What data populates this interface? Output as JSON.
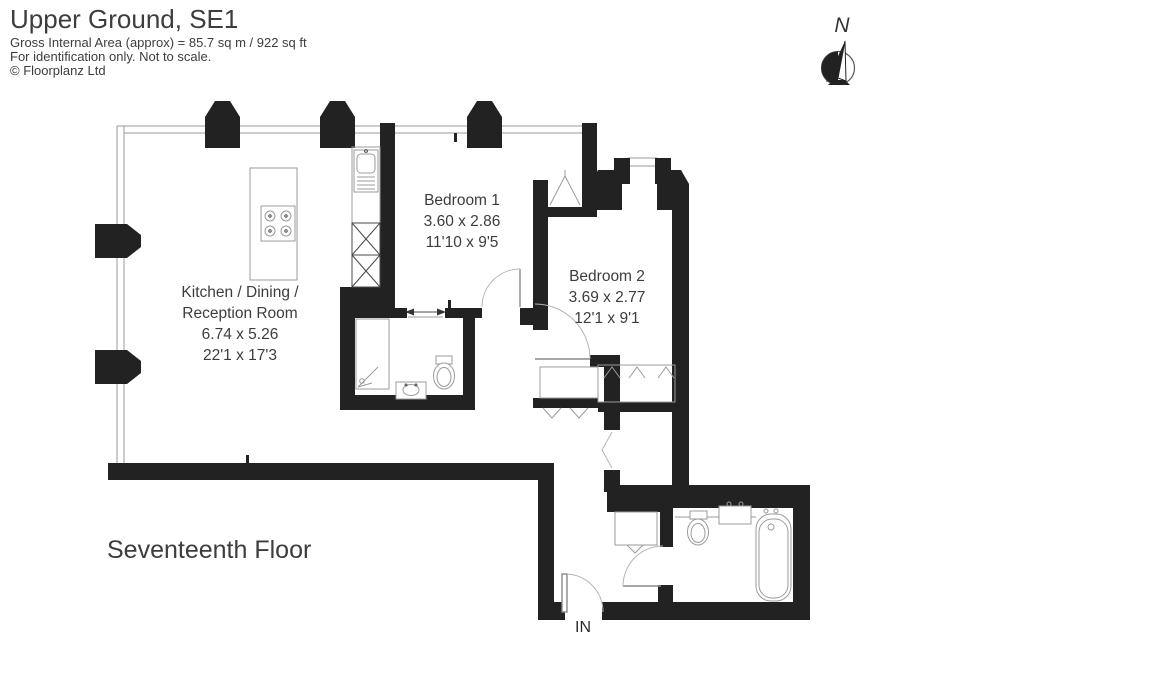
{
  "header": {
    "title": "Upper Ground, SE1",
    "subtitle": "Gross Internal Area (approx) = 85.7 sq m / 922 sq ft",
    "disclaimer": "For identification only. Not to scale.",
    "copyright": "© Floorplanz Ltd"
  },
  "compass": {
    "north_label": "N"
  },
  "rooms": {
    "kitchen": {
      "name_line1": "Kitchen / Dining /",
      "name_line2": "Reception Room",
      "metric": "6.74 x 5.26",
      "imperial": "22'1 x 17'3"
    },
    "bedroom1": {
      "name": "Bedroom 1",
      "metric": "3.60 x 2.86",
      "imperial": "11'10 x 9'5"
    },
    "bedroom2": {
      "name": "Bedroom 2",
      "metric": "3.69 x 2.77",
      "imperial": "12'1 x 9'1"
    }
  },
  "floor_label": "Seventeenth Floor",
  "entrance_label": "IN",
  "colors": {
    "wall": "#222222",
    "text": "#3d3d3d",
    "window_line": "#999999",
    "fixture_line": "#9b9b9b"
  }
}
